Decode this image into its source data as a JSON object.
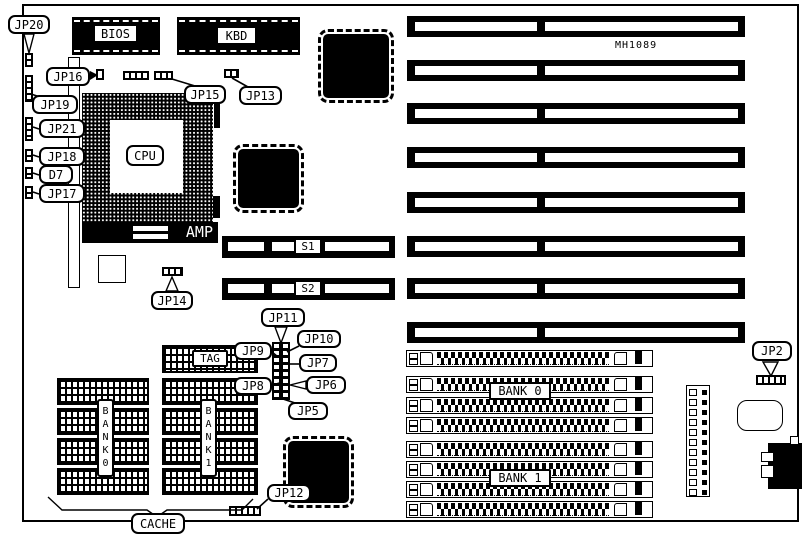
{
  "board": {
    "model": "MH1089"
  },
  "chips": {
    "bios": "BIOS",
    "kbd": "KBD",
    "cpu": "CPU",
    "amp": "AMP",
    "tag": "TAG"
  },
  "slots": {
    "s1": "S1",
    "s2": "S2"
  },
  "memory": {
    "cache_label": "CACHE",
    "cache_bank0": "BANK0",
    "cache_bank1": "BANK1",
    "simm_bank0": "BANK 0",
    "simm_bank1": "BANK 1"
  },
  "jumpers": {
    "jp2": "JP2",
    "jp5": "JP5",
    "jp6": "JP6",
    "jp7": "JP7",
    "jp8": "JP8",
    "jp9": "JP9",
    "jp10": "JP10",
    "jp11": "JP11",
    "jp12": "JP12",
    "jp13": "JP13",
    "jp14": "JP14",
    "jp15": "JP15",
    "jp16": "JP16",
    "jp17": "JP17",
    "jp18": "JP18",
    "jp19": "JP19",
    "jp20": "JP20",
    "jp21": "JP21",
    "d7": "D7"
  }
}
